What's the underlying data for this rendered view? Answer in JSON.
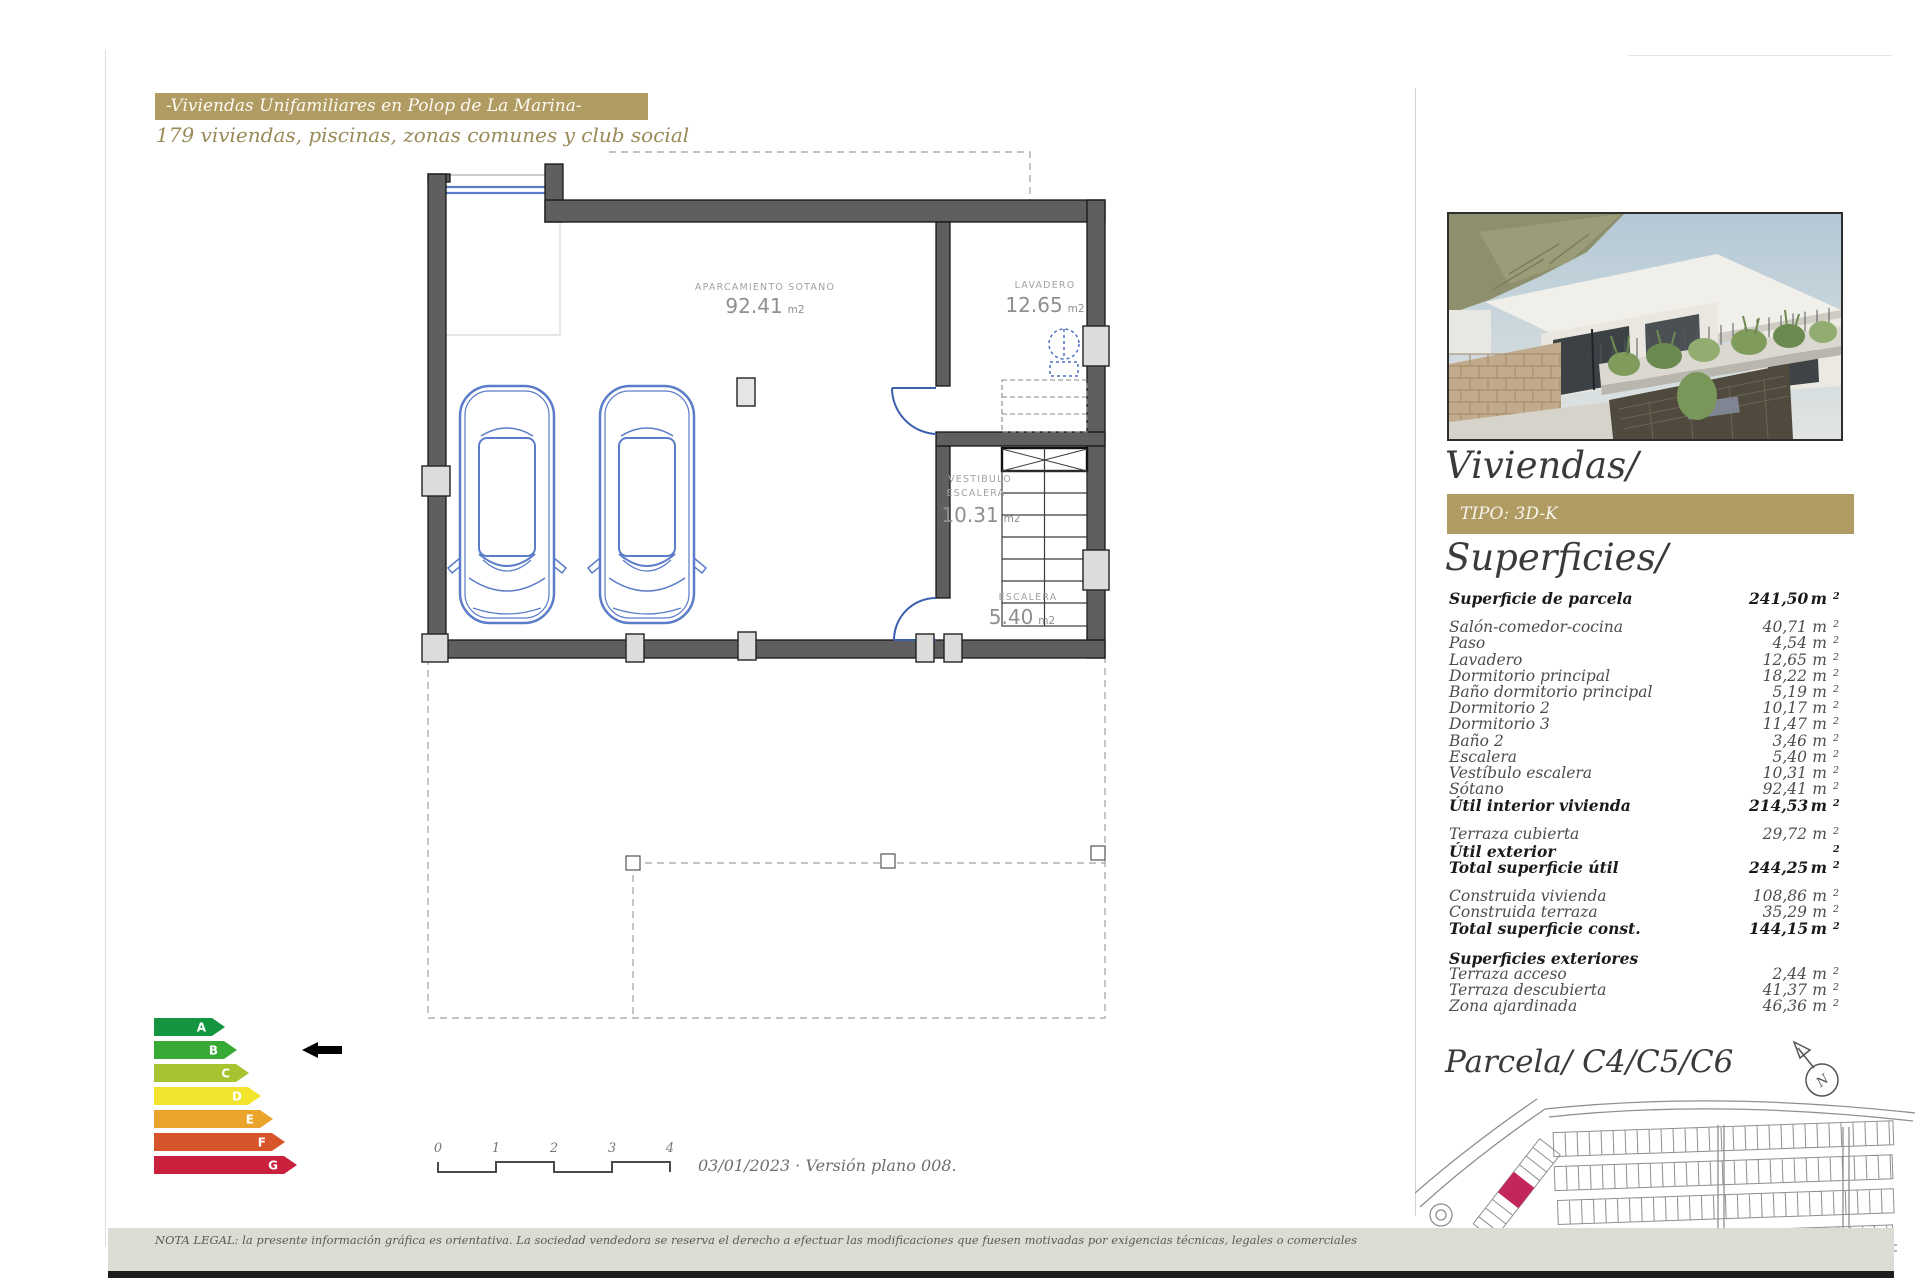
{
  "header": {
    "banner": "-Viviendas Unifamiliares en Polop de La Marina-",
    "subtitle": "179 viviendas, piscinas, zonas comunes y club social",
    "banner_color": "#b09b63"
  },
  "plan": {
    "rooms": {
      "garage": {
        "name": "APARCAMIENTO SOTANO",
        "area": "92.41",
        "unit": "m2"
      },
      "laundry": {
        "name": "LAVADERO",
        "area": "12.65",
        "unit": "m2"
      },
      "hall": {
        "line1": "VESTIBULO",
        "line2": "ESCALERA",
        "area": "10.31",
        "unit": "m2"
      },
      "stairs": {
        "name": "ESCALERA",
        "area": "5.40",
        "unit": "m2"
      }
    },
    "wall_color": "#5f5f5f",
    "car_color": "#5b7cc8"
  },
  "energy": {
    "levels": [
      {
        "letter": "A",
        "color": "#149640"
      },
      {
        "letter": "B",
        "color": "#39a935"
      },
      {
        "letter": "C",
        "color": "#a6c42f"
      },
      {
        "letter": "D",
        "color": "#f2e32c"
      },
      {
        "letter": "E",
        "color": "#eaa42c"
      },
      {
        "letter": "F",
        "color": "#d8552c"
      },
      {
        "letter": "G",
        "color": "#c8203d"
      }
    ],
    "pointer_letter": "B",
    "pointer_index": 1
  },
  "scale_bar": {
    "ticks": [
      "0",
      "1",
      "2",
      "3",
      "4"
    ]
  },
  "footer": {
    "date_version": "03/01/2023 · Versión plano 008.",
    "legal": "NOTA LEGAL: la presente información gráfica es orientativa. La sociedad vendedora se reserva el derecho a efectuar las modificaciones que fuesen motivadas por exigencias técnicas, legales o comerciales"
  },
  "panel": {
    "title": "Viviendas/",
    "tipo_label": "TIPO: 3D-K",
    "superficies_title": "Superficies/",
    "parcela_title": "Parcela/ C4/C5/C6",
    "compass_letter": "N",
    "highlight_color": "#c2265a",
    "surfaces": {
      "rows": [
        {
          "label": "Superficie de parcela",
          "value": "241,50",
          "bold": true
        },
        {
          "gap": true
        },
        {
          "label": "Salón-comedor-cocina",
          "value": "40,71"
        },
        {
          "label": "Paso",
          "value": "4,54"
        },
        {
          "label": "Lavadero",
          "value": "12,65"
        },
        {
          "label": "Dormitorio principal",
          "value": "18,22"
        },
        {
          "label": "Baño dormitorio principal",
          "value": "5,19"
        },
        {
          "label": "Dormitorio 2",
          "value": "10,17"
        },
        {
          "label": "Dormitorio 3",
          "value": "11,47"
        },
        {
          "label": "Baño 2",
          "value": "3,46"
        },
        {
          "label": "Escalera",
          "value": "5,40"
        },
        {
          "label": "Vestíbulo escalera",
          "value": "10,31"
        },
        {
          "label": "Sótano",
          "value": "92,41"
        },
        {
          "label": "Útil interior vivienda",
          "value": "214,53",
          "bold": true
        },
        {
          "gap": true
        },
        {
          "label": "Terraza cubierta",
          "value": "29,72"
        },
        {
          "label": "Útil exterior",
          "value": "",
          "bold": true
        },
        {
          "label": "Total superficie útil",
          "value": "244,25",
          "bold": true
        },
        {
          "gap": true
        },
        {
          "label": "Construida vivienda",
          "value": "108,86"
        },
        {
          "label": "Construida terraza",
          "value": "35,29"
        },
        {
          "label": "Total superficie const.",
          "value": "144,15",
          "bold": true
        },
        {
          "gap": true
        },
        {
          "label": "Superficies exteriores",
          "heading": true,
          "bold": true
        },
        {
          "label": "Terraza acceso",
          "value": "2,44"
        },
        {
          "label": "Terraza descubierta",
          "value": "41,37"
        },
        {
          "label": "Zona ajardinada",
          "value": "46,36"
        }
      ]
    }
  }
}
